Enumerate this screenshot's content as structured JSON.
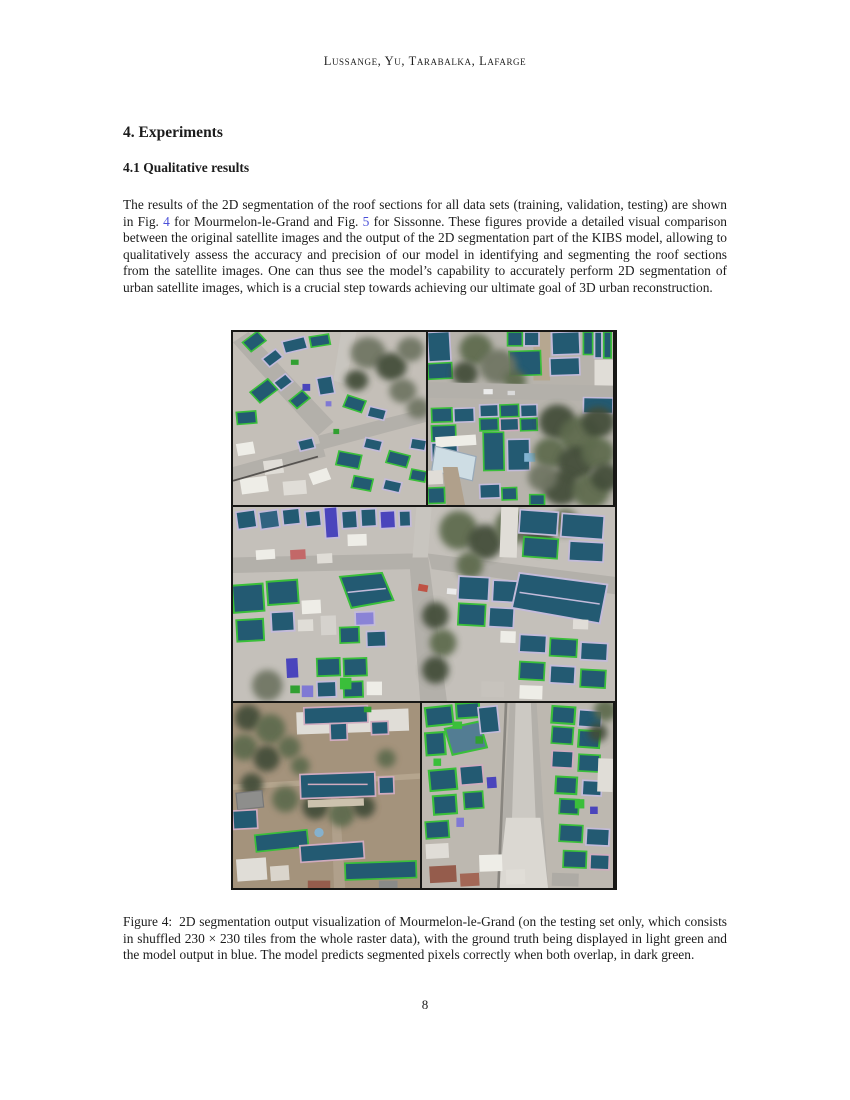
{
  "header": {
    "running_head": "Lussange, Yu, Tarabalka, Lafarge"
  },
  "section": {
    "heading": "4. Experiments",
    "subsection": "4.1 Qualitative results"
  },
  "paragraph": {
    "part1": "The results of the 2D segmentation of the roof sections for all data sets (training, validation, testing) are shown in Fig. ",
    "fig4_link": "4",
    "part2": " for Mourmelon-le-Grand and Fig. ",
    "fig5_link": "5",
    "part3": " for Sissonne. These figures provide a detailed visual comparison between the original satellite images and the output of the 2D segmentation part of the KIBS model, allowing to qualitatively assess the accuracy and precision of our model in identifying and segmenting the roof sections from the satellite images. One can thus see the model’s capability to accurately perform 2D segmentation of urban satellite images, which is a crucial step towards achieving our ultimate goal of 3D urban reconstruction."
  },
  "figure": {
    "caption_label": "Figure 4:",
    "caption_text": "2D segmentation output visualization of Mourmelon-le-Grand (on the testing set only, which consists in shuffled 230 × 230 tiles from the whole raster data), with the ground truth being displayed in light green and the model output in blue. The model predicts segmented pixels correctly when both overlap, in dark green.",
    "description": "Mosaic of five satellite-image tiles with roof-section segmentation overlays",
    "tiles": [
      "top-left",
      "top-right",
      "middle",
      "bottom-left",
      "bottom-right"
    ],
    "legend_colors": {
      "ground_truth_light_green": "#2fc42f",
      "model_output_blue": "#4842c8",
      "overlap_dark_green": "#1c5a75"
    }
  },
  "footer": {
    "page_number": "8"
  },
  "colors": {
    "link_blue": "#4a4fd8"
  }
}
